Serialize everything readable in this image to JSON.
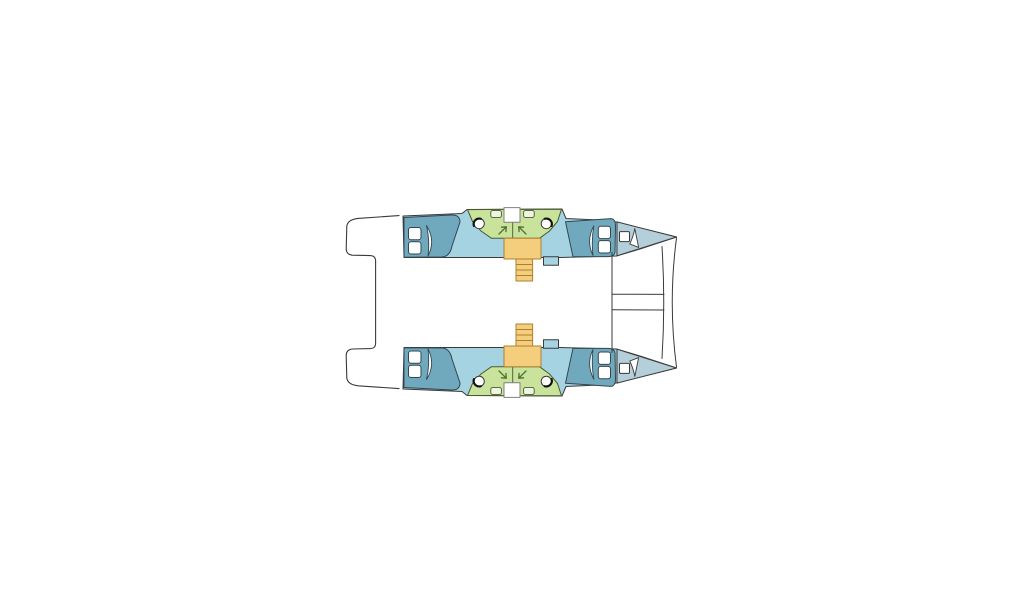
{
  "page": {
    "background": "#ffffff",
    "kind": "catamaran-deck-floor-plan"
  },
  "colors": {
    "outline": "#3a3a3a",
    "hull": "#a6d3e2",
    "bow_deck": "#b4cfd9",
    "bed": "#70a8bd",
    "bed_outline": "#33464f",
    "seating": "#c9e39d",
    "seating_outline": "#4a5a30",
    "stairs": "#f5ce7d",
    "stairs_outline": "#ad8030",
    "fixture_white": "#ffffff",
    "fixture_fill": "#eef5e0",
    "sink_accent": "#111111",
    "arrow": "#4e7030",
    "door_outline": "#808080"
  },
  "components": {
    "port_hull": "port-hull",
    "starboard_hull": "starboard-hull-mirrored",
    "aft_platform": "aft-platform-outline",
    "forward_crossbeam": "forward-crossbeam-lines",
    "aft_berth": "aft-cabin-double-berth",
    "forward_berth": "forward-cabin-double-berth",
    "heads_area": "heads-settee-area",
    "staircase": "companionway-staircase",
    "bow_locker": "bow-locker-deck"
  }
}
